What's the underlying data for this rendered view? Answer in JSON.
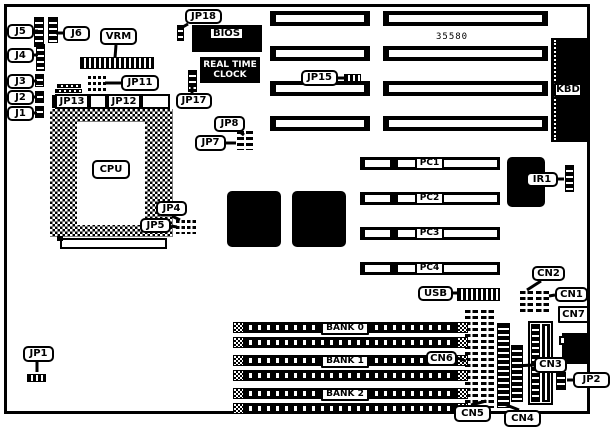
{
  "figure": {
    "width": 612,
    "height": 431,
    "board": {
      "x": 4,
      "y": 4,
      "w": 586,
      "h": 410
    }
  },
  "texts": {
    "chipset": "35580",
    "rtc_line1": "REAL TIME",
    "rtc_line2": "CLOCK"
  },
  "isa_slots": {
    "rows_y": [
      11,
      46,
      81,
      116
    ],
    "height": 15,
    "seg_a": {
      "x": 270,
      "w": 100
    },
    "seg_b": {
      "x": 383,
      "w": 165
    },
    "stripe_inset_x": 6,
    "stripe_top": 4,
    "stripe_h": 7
  },
  "pci_slots": {
    "rows_y": [
      157,
      192,
      227,
      262
    ],
    "x": 360,
    "w": 140,
    "h": 13,
    "stripes": [
      [
        365,
        25
      ],
      [
        398,
        18
      ],
      [
        443,
        54
      ]
    ],
    "stripe_top": 3,
    "stripe_h": 7,
    "labels": [
      "PC1",
      "PC2",
      "PC3",
      "PC4"
    ],
    "label_x": 415,
    "label_w": 29,
    "label_h": 13
  },
  "simm": {
    "rows_y": [
      322,
      337,
      355,
      370,
      388,
      403
    ],
    "x": 233,
    "w": 235,
    "h": 11,
    "cap_w": 11,
    "banks": [
      {
        "label": "BANK 0",
        "y": 322
      },
      {
        "label": "BANK 1",
        "y": 355
      },
      {
        "label": "BANK 2",
        "y": 388
      }
    ],
    "bank_label_x": 321,
    "bank_label_w": 48,
    "bank_label_h": 13
  },
  "cpu": {
    "socket": [
      50,
      109,
      123,
      128
    ],
    "inner": [
      77,
      122,
      68,
      103
    ],
    "strip_tick": [
      52,
      95,
      3,
      13
    ],
    "strip_boxes": [
      [
        55,
        94,
        34,
        15
      ],
      [
        89,
        94,
        18,
        15
      ],
      [
        107,
        94,
        34,
        15
      ],
      [
        141,
        94,
        29,
        15
      ]
    ],
    "below_slot": [
      60,
      238,
      107,
      11
    ],
    "below_notch": [
      57,
      236,
      6,
      5
    ]
  },
  "chips": [
    {
      "name": "bios-chip",
      "type": "solid-chip",
      "x": 192,
      "y": 25,
      "w": 70,
      "h": 27
    },
    {
      "name": "rtc-chip",
      "type": "rtc",
      "x": 200,
      "y": 57,
      "w": 60,
      "h": 26
    },
    {
      "name": "kbd-connector",
      "type": "kbd",
      "x": 551,
      "y": 38,
      "w": 37,
      "h": 104
    },
    {
      "name": "qfp-chip-1",
      "type": "jagged",
      "x": 227,
      "y": 191,
      "w": 54,
      "h": 56
    },
    {
      "name": "qfp-chip-2",
      "type": "jagged",
      "x": 292,
      "y": 191,
      "w": 54,
      "h": 56
    },
    {
      "name": "ir1-chip",
      "type": "jagged",
      "x": 507,
      "y": 157,
      "w": 38,
      "h": 50
    },
    {
      "name": "power-connector",
      "type": "power",
      "x": 528,
      "y": 321,
      "w": 25,
      "h": 84
    },
    {
      "name": "din-connector",
      "type": "din",
      "x": 562,
      "y": 333,
      "w": 28,
      "h": 31,
      "notch": [
        559,
        336,
        7,
        9
      ]
    }
  ],
  "headers": [
    {
      "name": "j5-pin-header",
      "x": 34,
      "y": 17,
      "w": 10,
      "h": 30,
      "pattern": "vstripe"
    },
    {
      "name": "j6-pin-header",
      "x": 48,
      "y": 17,
      "w": 10,
      "h": 26,
      "pattern": "vstripe"
    },
    {
      "name": "j4-pin-header",
      "x": 36,
      "y": 44,
      "w": 9,
      "h": 27,
      "pattern": "vstripe"
    },
    {
      "name": "j3-pin-header",
      "x": 35,
      "y": 74,
      "w": 9,
      "h": 13,
      "pattern": "vstripe"
    },
    {
      "name": "j2-pin-header",
      "x": 35,
      "y": 91,
      "w": 9,
      "h": 12,
      "pattern": "vstripe"
    },
    {
      "name": "j1-pin-header",
      "x": 35,
      "y": 106,
      "w": 9,
      "h": 12,
      "pattern": "vstripe"
    },
    {
      "name": "vrm-connector",
      "x": 80,
      "y": 57,
      "w": 74,
      "h": 12,
      "pattern": "hstripe"
    },
    {
      "name": "cap-a",
      "x": 57,
      "y": 84,
      "w": 24,
      "h": 4,
      "pattern": "hstripe"
    },
    {
      "name": "cap-b",
      "x": 55,
      "y": 89,
      "w": 27,
      "h": 4,
      "pattern": "hstripe"
    },
    {
      "name": "jp11-header-left",
      "x": 88,
      "y": 76,
      "w": 8,
      "h": 16,
      "pattern": "grid"
    },
    {
      "name": "jp11-header-right",
      "x": 98,
      "y": 76,
      "w": 8,
      "h": 16,
      "pattern": "grid"
    },
    {
      "name": "jp18-header",
      "x": 177,
      "y": 25,
      "w": 7,
      "h": 16,
      "pattern": "vstripe"
    },
    {
      "name": "jp17-header",
      "x": 188,
      "y": 70,
      "w": 9,
      "h": 22,
      "pattern": "vstripe"
    },
    {
      "name": "jp15-header",
      "x": 344,
      "y": 74,
      "w": 17,
      "h": 8,
      "pattern": "hstripe"
    },
    {
      "name": "jp7-jp8-header",
      "x": 237,
      "y": 131,
      "w": 16,
      "h": 19,
      "pattern": "grid"
    },
    {
      "name": "jp5-header",
      "x": 176,
      "y": 220,
      "w": 9,
      "h": 14,
      "pattern": "grid"
    },
    {
      "name": "jp4-header",
      "x": 187,
      "y": 220,
      "w": 9,
      "h": 14,
      "pattern": "grid"
    },
    {
      "name": "jp1-header",
      "x": 27,
      "y": 374,
      "w": 19,
      "h": 8,
      "pattern": "hstripe"
    },
    {
      "name": "ir1-header",
      "x": 565,
      "y": 165,
      "w": 9,
      "h": 27,
      "pattern": "vstripe"
    },
    {
      "name": "usb-header",
      "x": 457,
      "y": 288,
      "w": 43,
      "h": 13,
      "pattern": "hstripe"
    },
    {
      "name": "cn2-block",
      "x": 520,
      "y": 291,
      "w": 13,
      "h": 24,
      "pattern": "grid"
    },
    {
      "name": "cn1-block",
      "x": 536,
      "y": 291,
      "w": 13,
      "h": 24,
      "pattern": "grid"
    },
    {
      "name": "cn6-connector",
      "x": 465,
      "y": 310,
      "w": 13,
      "h": 98,
      "pattern": "grid"
    },
    {
      "name": "cn5-connector",
      "x": 481,
      "y": 310,
      "w": 13,
      "h": 98,
      "pattern": "grid"
    },
    {
      "name": "cn4-connector",
      "x": 497,
      "y": 323,
      "w": 13,
      "h": 85,
      "pattern": "vstripe"
    },
    {
      "name": "cn3-connector",
      "x": 511,
      "y": 345,
      "w": 12,
      "h": 57,
      "pattern": "vstripe"
    },
    {
      "name": "jp2-header",
      "x": 556,
      "y": 372,
      "w": 10,
      "h": 18,
      "pattern": "vstripe"
    }
  ],
  "labels": [
    {
      "name": "label-j5",
      "text": "J5",
      "x": 7,
      "y": 24,
      "w": 27,
      "h": 15,
      "style": "round",
      "tail": [
        [
          34,
          31
        ],
        [
          38,
          31
        ]
      ]
    },
    {
      "name": "label-j6",
      "text": "J6",
      "x": 63,
      "y": 26,
      "w": 27,
      "h": 15,
      "style": "round",
      "tail": [
        [
          63,
          33
        ],
        [
          56,
          33
        ]
      ]
    },
    {
      "name": "label-vrm",
      "text": "VRM",
      "x": 100,
      "y": 28,
      "w": 37,
      "h": 17,
      "style": "round",
      "tail": [
        [
          116,
          45
        ],
        [
          115,
          58
        ]
      ]
    },
    {
      "name": "label-j4",
      "text": "J4",
      "x": 7,
      "y": 48,
      "w": 27,
      "h": 15,
      "style": "round",
      "tail": [
        [
          34,
          55
        ],
        [
          38,
          55
        ]
      ]
    },
    {
      "name": "label-j3",
      "text": "J3",
      "x": 7,
      "y": 74,
      "w": 27,
      "h": 15,
      "style": "round",
      "tail": [
        [
          34,
          81
        ],
        [
          37,
          81
        ]
      ]
    },
    {
      "name": "label-j2",
      "text": "J2",
      "x": 7,
      "y": 90,
      "w": 27,
      "h": 15,
      "style": "round",
      "tail": [
        [
          34,
          97
        ],
        [
          37,
          97
        ]
      ]
    },
    {
      "name": "label-j1",
      "text": "J1",
      "x": 7,
      "y": 106,
      "w": 27,
      "h": 15,
      "style": "round",
      "tail": [
        [
          34,
          113
        ],
        [
          37,
          113
        ]
      ]
    },
    {
      "name": "label-jp18",
      "text": "JP18",
      "x": 185,
      "y": 9,
      "w": 37,
      "h": 15,
      "style": "round",
      "tail": [
        [
          188,
          24
        ],
        [
          181,
          28
        ]
      ]
    },
    {
      "name": "label-jp11",
      "text": "JP11",
      "x": 121,
      "y": 75,
      "w": 38,
      "h": 16,
      "style": "round",
      "tail": [
        [
          121,
          83
        ],
        [
          105,
          83
        ]
      ]
    },
    {
      "name": "label-jp17",
      "text": "JP17",
      "x": 176,
      "y": 93,
      "w": 36,
      "h": 16,
      "style": "round",
      "tail": [
        [
          192,
          93
        ],
        [
          192,
          86
        ]
      ]
    },
    {
      "name": "label-jp15",
      "text": "JP15",
      "x": 301,
      "y": 70,
      "w": 37,
      "h": 16,
      "style": "round",
      "tail": [
        [
          338,
          78
        ],
        [
          346,
          78
        ]
      ]
    },
    {
      "name": "label-jp8",
      "text": "JP8",
      "x": 214,
      "y": 116,
      "w": 31,
      "h": 16,
      "style": "round",
      "tail": [
        [
          240,
          132
        ],
        [
          244,
          135
        ]
      ]
    },
    {
      "name": "label-jp7",
      "text": "JP7",
      "x": 195,
      "y": 135,
      "w": 31,
      "h": 16,
      "style": "round",
      "tail": [
        [
          226,
          143
        ],
        [
          236,
          143
        ]
      ]
    },
    {
      "name": "label-jp13",
      "text": "JP13",
      "x": 55,
      "y": 94,
      "w": 34,
      "h": 15,
      "style": "flat"
    },
    {
      "name": "label-jp12",
      "text": "JP12",
      "x": 107,
      "y": 94,
      "w": 34,
      "h": 15,
      "style": "flat"
    },
    {
      "name": "label-jp4",
      "text": "JP4",
      "x": 156,
      "y": 201,
      "w": 31,
      "h": 15,
      "style": "round",
      "tail": [
        [
          172,
          216
        ],
        [
          180,
          220
        ]
      ]
    },
    {
      "name": "label-jp5",
      "text": "JP5",
      "x": 140,
      "y": 218,
      "w": 31,
      "h": 15,
      "style": "round",
      "tail": [
        [
          171,
          226
        ],
        [
          177,
          227
        ]
      ]
    },
    {
      "name": "label-cpu",
      "text": "CPU",
      "x": 92,
      "y": 160,
      "w": 38,
      "h": 19,
      "style": "round"
    },
    {
      "name": "label-jp1",
      "text": "JP1",
      "x": 23,
      "y": 346,
      "w": 31,
      "h": 16,
      "style": "round",
      "tail": [
        [
          37,
          362
        ],
        [
          37,
          372
        ]
      ]
    },
    {
      "name": "label-ir1",
      "text": "IR1",
      "x": 526,
      "y": 172,
      "w": 32,
      "h": 15,
      "style": "round",
      "tail": [
        [
          558,
          179
        ],
        [
          564,
          179
        ]
      ]
    },
    {
      "name": "label-usb",
      "text": "USB",
      "x": 418,
      "y": 286,
      "w": 35,
      "h": 15,
      "style": "round",
      "tail": [
        [
          453,
          293
        ],
        [
          457,
          293
        ]
      ]
    },
    {
      "name": "label-cn2",
      "text": "CN2",
      "x": 532,
      "y": 266,
      "w": 33,
      "h": 15,
      "style": "round",
      "tail": [
        [
          541,
          281
        ],
        [
          527,
          290
        ]
      ]
    },
    {
      "name": "label-cn1",
      "text": "CN1",
      "x": 555,
      "y": 287,
      "w": 33,
      "h": 15,
      "style": "round",
      "tail": [
        [
          555,
          295
        ],
        [
          549,
          296
        ]
      ]
    },
    {
      "name": "label-cn7",
      "text": "CN7",
      "x": 558,
      "y": 306,
      "w": 31,
      "h": 17,
      "style": "flat"
    },
    {
      "name": "label-cn3",
      "text": "CN3",
      "x": 534,
      "y": 357,
      "w": 33,
      "h": 16,
      "style": "round",
      "tail": [
        [
          534,
          365
        ],
        [
          514,
          366
        ]
      ]
    },
    {
      "name": "label-cn6",
      "text": "CN6",
      "x": 426,
      "y": 351,
      "w": 31,
      "h": 15,
      "style": "round",
      "tail": [
        [
          457,
          358
        ],
        [
          466,
          361
        ]
      ]
    },
    {
      "name": "label-cn5",
      "text": "CN5",
      "x": 454,
      "y": 405,
      "w": 37,
      "h": 17,
      "style": "round",
      "tail": [
        [
          471,
          405
        ],
        [
          486,
          401
        ]
      ]
    },
    {
      "name": "label-cn4",
      "text": "CN4",
      "x": 504,
      "y": 410,
      "w": 37,
      "h": 17,
      "style": "round",
      "tail": [
        [
          519,
          410
        ],
        [
          504,
          404
        ]
      ]
    },
    {
      "name": "label-jp2",
      "text": "JP2",
      "x": 573,
      "y": 372,
      "w": 37,
      "h": 16,
      "style": "round",
      "tail": [
        [
          573,
          380
        ],
        [
          567,
          380
        ]
      ]
    },
    {
      "name": "label-kbd",
      "text": "KBD",
      "x": 554,
      "y": 83,
      "w": 28,
      "h": 14,
      "style": "flat"
    },
    {
      "name": "label-bios",
      "text": "BIOS",
      "x": 209,
      "y": 27,
      "w": 35,
      "h": 13,
      "style": "flat"
    }
  ]
}
